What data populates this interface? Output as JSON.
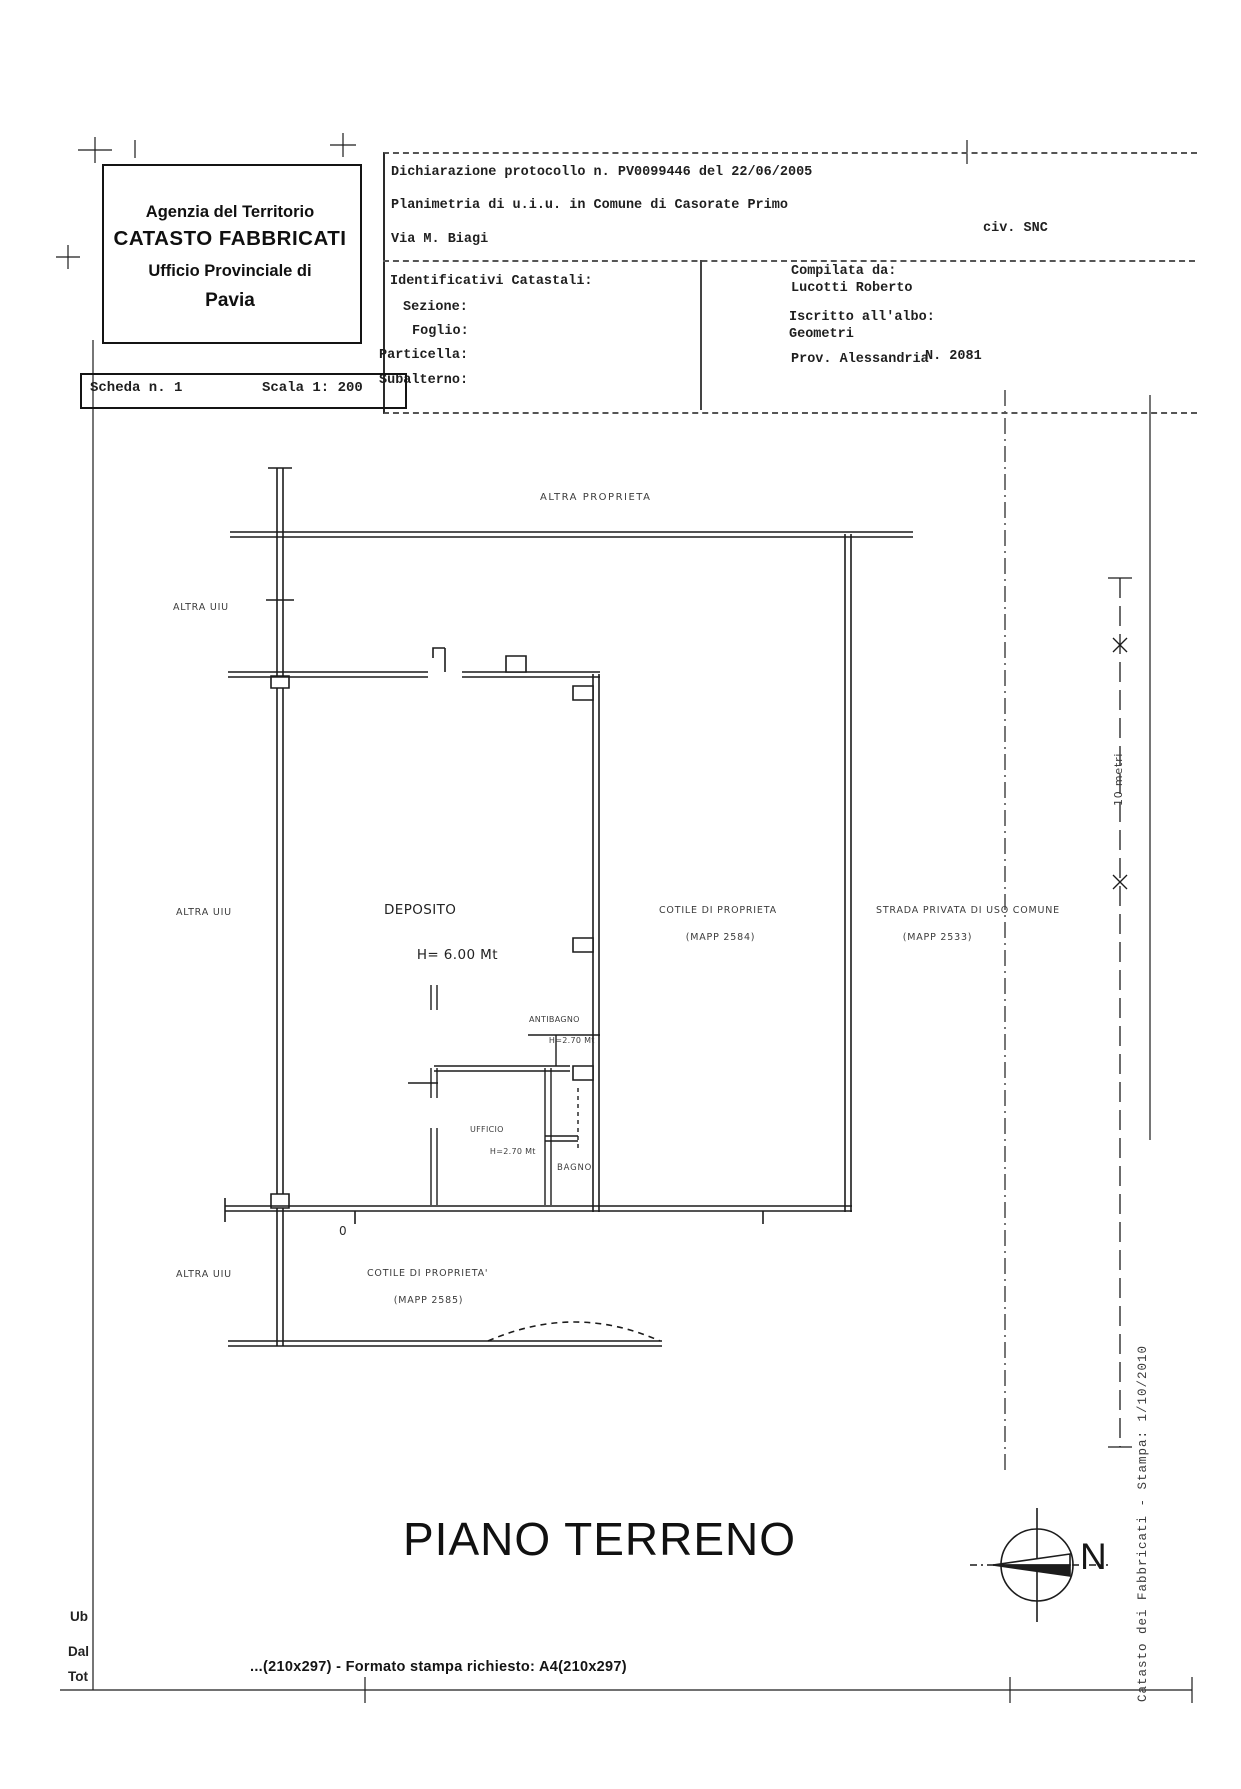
{
  "header": {
    "agency": {
      "line1": "Agenzia del Territorio",
      "line2": "CATASTO FABBRICATI",
      "line3": "Ufficio Provinciale di",
      "line4": "Pavia"
    },
    "declaration": {
      "protocol": "Dichiarazione protocollo n. PV0099446 del 22/06/2005",
      "planimetria": "Planimetria di u.i.u. in Comune di Casorate Primo",
      "street": "Via M. Biagi",
      "civ": "civ. SNC"
    },
    "catasto": {
      "title": "Identificativi Catastali:",
      "sezione": "Sezione:",
      "foglio": "Foglio:",
      "particella": "Particella:",
      "subalterno": "Subalterno:"
    },
    "compiler": {
      "compilata_label": "Compilata da:",
      "compilata_name": "Lucotti Roberto",
      "albo_label": "Iscritto all'albo:",
      "albo_value": "Geometri",
      "prov": "Prov. Alessandria",
      "number": "N. 2081"
    }
  },
  "scheda": {
    "scheda": "Scheda n. 1",
    "scala": "Scala 1: 200"
  },
  "plan": {
    "labels": {
      "altra_proprieta": "ALTRA PROPRIETA",
      "altra_uiu": "ALTRA UIU",
      "deposito_name": "DEPOSITO",
      "deposito_h": "H= 6.00 Mt",
      "cortile1_name": "COTILE DI PROPRIETA",
      "cortile1_mapp": "(MAPP 2584)",
      "strada_name": "STRADA PRIVATA DI USO COMUNE",
      "strada_mapp": "(MAPP 2533)",
      "antibagno_name": "ANTIBAGNO",
      "antibagno_h": "H=2.70 Mt",
      "ufficio_name": "UFFICIO",
      "ufficio_h": "H=2.70 Mt",
      "bagno_name": "BAGNO",
      "cortile2_name": "COTILE DI PROPRIETA'",
      "cortile2_mapp": "(MAPP 2585)",
      "zero_mark": "0"
    },
    "title": "PIANO TERRENO",
    "compass_n": "N",
    "ruler_label": "10 metri"
  },
  "margins": {
    "sidebar_text": "Catasto dei Fabbricati - Stampa: 1/10/2010",
    "left_fragments": [
      "Ub",
      "Dal",
      "Tot"
    ],
    "print_line": "...(210x297) - Formato stampa richiesto: A4(210x297)"
  }
}
